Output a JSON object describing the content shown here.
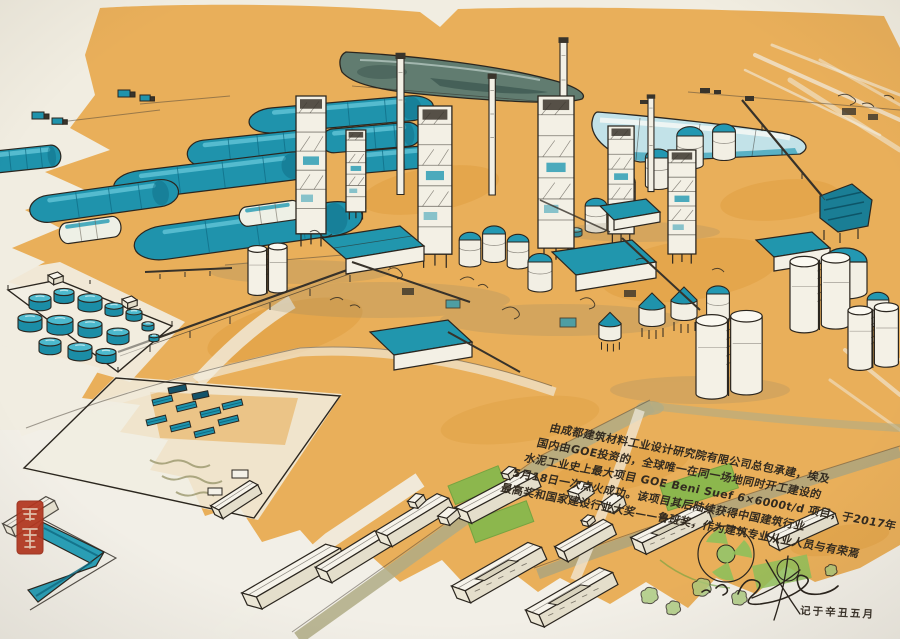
{
  "artwork": {
    "type": "watercolor-ink-illustration",
    "subject": "aerial view of a large cement plant complex with storage sheds, silos, tank farm and worker housing",
    "annotation": {
      "lines": [
        "由成都建筑材料工业设计研究院有限公司总包承建，埃及",
        "国内由GOE投资的，全球唯一在同一场地同时开工建设的",
        "水泥工业史上最大项目 GOE Beni Suef 6×6000t/d 项目，于2017年",
        "5月18日一次点火成功。该项目其后陆续获得中国建筑行业",
        "最高奖和国家建设行业大奖——鲁班奖，作为建筑专业从业人员与有荣焉"
      ]
    },
    "inscription": {
      "date_note": "记于辛丑五月"
    },
    "seal": {
      "label": "artist-red-seal"
    },
    "palette": {
      "paper": "#f1ede1",
      "ground_wash": "#e8a94e",
      "ground_deep": "#d9922f",
      "teal": "#2398b2",
      "teal_dark": "#0f6f8a",
      "teal_light": "#7fd0dd",
      "ink": "#2b261f",
      "basin": "#5c7a6e",
      "lawn_green": "#84b94e",
      "road_olive": "#aaa67f",
      "seal_red": "#b23a22"
    }
  }
}
